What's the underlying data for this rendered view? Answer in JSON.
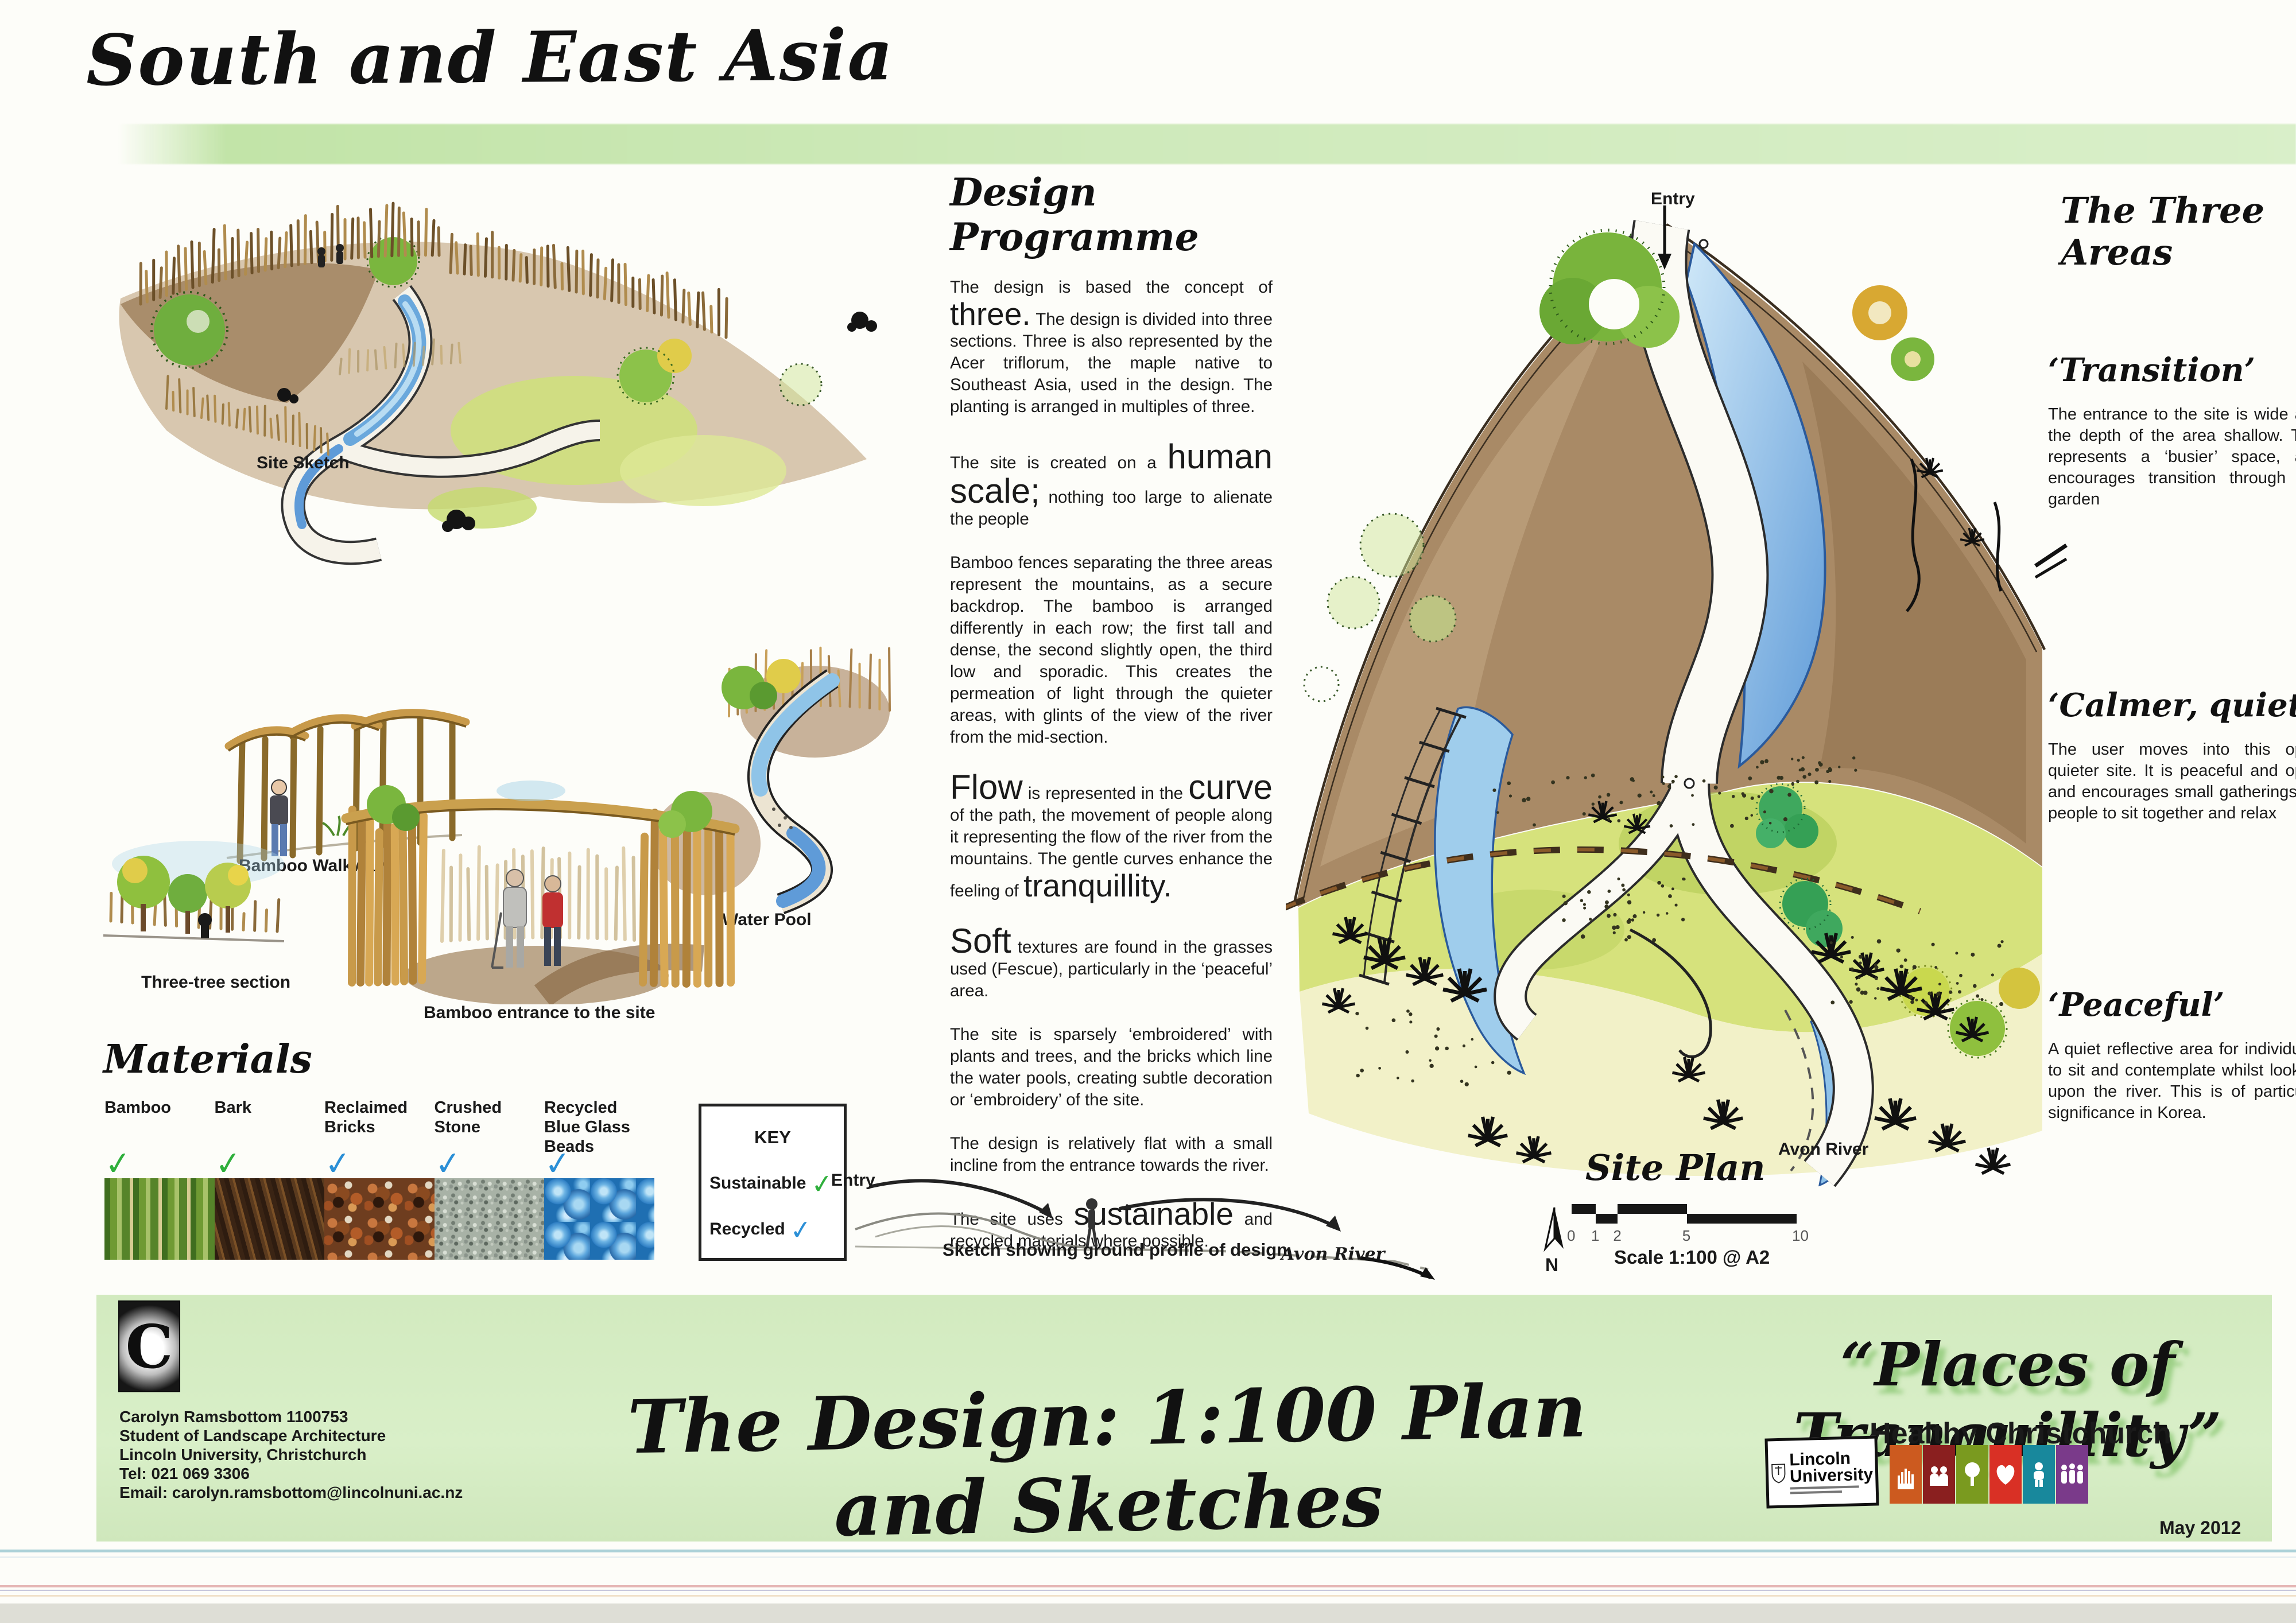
{
  "header": {
    "title": "South and East Asia"
  },
  "sketches": {
    "site_sketch_label": "Site Sketch",
    "bamboo_walkway_label": "Bamboo Walkway",
    "water_pool_label": "Water Pool",
    "three_tree_label": "Three-tree section",
    "bamboo_entrance_label": "Bamboo entrance to the site"
  },
  "design_programme": {
    "heading": "Design Programme",
    "p1_pre": "The design is based the concept of",
    "p1_big": "three.",
    "p1_post": "The design is divided into three sections. Three is also represented by the Acer triflorum, the maple native to Southeast Asia, used in the design. The planting is arranged in multiples of three.",
    "p2_pre": "The site is created on a",
    "p2_big": "human scale;",
    "p2_post": "nothing too large to alienate the people",
    "p3": "Bamboo fences separating the three areas represent the mountains, as a secure backdrop. The bamboo is arranged differently in each row; the first tall and dense, the second slightly open, the third low and sporadic. This creates the permeation of light through the quieter areas, with glints of the view of the river from the mid-section.",
    "p4_big1": "Flow",
    "p4_mid1": "is represented in the",
    "p4_big2": "curve",
    "p4_post1": "of the path, the movement of people along it representing the flow of the river from the mountains. The gentle curves enhance",
    "p4_mid2": "the feeling of",
    "p4_big3": "tranquillity.",
    "p5_big": "Soft",
    "p5_post": "textures are found in the grasses used (Fescue), particularly in the ‘peaceful’ area.",
    "p6": "The site is sparsely ‘embroidered’ with plants and trees, and the bricks which line the water pools, creating subtle decoration or ‘embroidery’ of the site.",
    "p7": "The design is relatively flat with a small incline from the entrance towards the river.",
    "p8_pre": "The site uses",
    "p8_big": "sustainable",
    "p8_post": "and recycled materials where possible."
  },
  "three_areas": {
    "heading": "The Three Areas",
    "sections": [
      {
        "title": "‘Transition’",
        "body": "The entrance to the site is wide and the depth of the area shallow. This represents a ‘busier’ space, and encourages transition through the garden"
      },
      {
        "title": "‘Calmer, quiet’",
        "body": "The user moves into this open quieter site. It is peaceful and open and encourages small gatherings for people to sit together and relax"
      },
      {
        "title": "‘Peaceful’",
        "body": "A quiet reflective area for individuals to sit and contemplate whilst looking upon the river. This is of particular significance in Korea."
      }
    ]
  },
  "site_plan": {
    "entry_label": "Entry",
    "plan_label": "Site Plan",
    "river_label": "Avon River",
    "north_label": "N",
    "scale_ticks": [
      "0",
      "1",
      "2",
      "5",
      "10"
    ],
    "scale_label": "Scale 1:100 @ A2"
  },
  "profile": {
    "entry_label": "Entry",
    "caption": "Sketch showing ground profile of design",
    "river_label": "Avon River"
  },
  "materials": {
    "heading": "Materials",
    "check_glyph": "✓",
    "colors": {
      "sustainable": "#2faf3c",
      "recycled": "#2b8fd6"
    },
    "items": [
      {
        "name": "Bamboo",
        "status": "sustainable"
      },
      {
        "name": "Bark",
        "status": "sustainable"
      },
      {
        "name": "Reclaimed Bricks",
        "status": "recycled"
      },
      {
        "name": "Crushed Stone",
        "status": "recycled"
      },
      {
        "name": "Recycled Blue Glass Beads",
        "status": "recycled"
      }
    ],
    "key": {
      "title": "KEY",
      "sustainable_label": "Sustainable",
      "recycled_label": "Recycled"
    }
  },
  "footer": {
    "logo_letter": "C",
    "author_lines": [
      "Carolyn Ramsbottom 1100753",
      "Student of Landscape Architecture",
      "Lincoln University, Christchurch",
      "Tel: 021 069 3306",
      "Email: carolyn.ramsbottom@lincolnuni.ac.nz"
    ],
    "main_title": "The Design: 1:100 Plan and Sketches",
    "quote_title": "“Places of Tranquillity”",
    "programme_name": "Healthy Christchurch",
    "university_line1": "Lincoln",
    "university_line2": "University",
    "date": "May 2012",
    "tiles": [
      {
        "glyph": "hand",
        "color": "#cc5a1f"
      },
      {
        "glyph": "family",
        "color": "#8a1f1f"
      },
      {
        "glyph": "tree",
        "color": "#7a9a1f"
      },
      {
        "glyph": "heart",
        "color": "#d93025"
      },
      {
        "glyph": "person",
        "color": "#18889c"
      },
      {
        "glyph": "children",
        "color": "#7a3a8a"
      }
    ]
  }
}
